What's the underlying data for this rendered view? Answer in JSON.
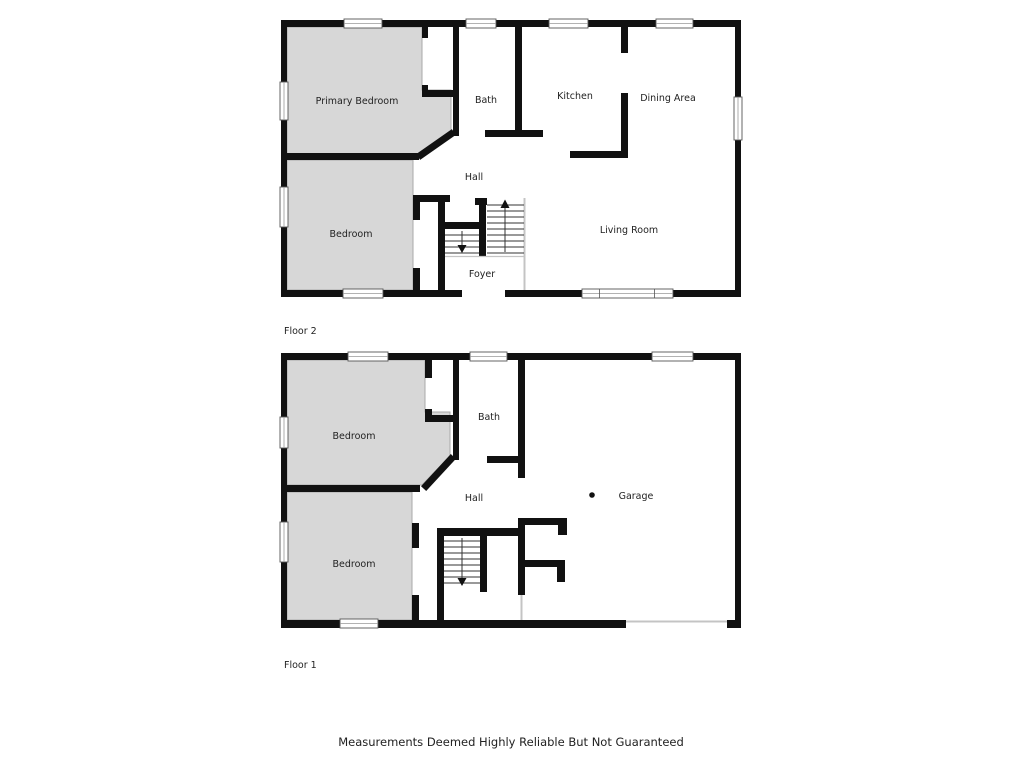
{
  "disclaimer": "Measurements Deemed Highly Reliable But Not Guaranteed",
  "floor2": {
    "label": "Floor 2",
    "rooms": {
      "primary_bedroom": "Primary Bedroom",
      "bath": "Bath",
      "kitchen": "Kitchen",
      "dining": "Dining Area",
      "hall": "Hall",
      "living": "Living Room",
      "bedroom": "Bedroom",
      "foyer": "Foyer"
    }
  },
  "floor1": {
    "label": "Floor 1",
    "rooms": {
      "bedroom_top": "Bedroom",
      "bath": "Bath",
      "hall": "Hall",
      "bedroom_bottom": "Bedroom",
      "garage": "Garage"
    }
  },
  "colors": {
    "wall": "#111111",
    "room_fill": "#d7d7d7",
    "room_outline": "#aaaaaa",
    "thin_line": "#c4c4c4",
    "label_text": "#222222"
  }
}
